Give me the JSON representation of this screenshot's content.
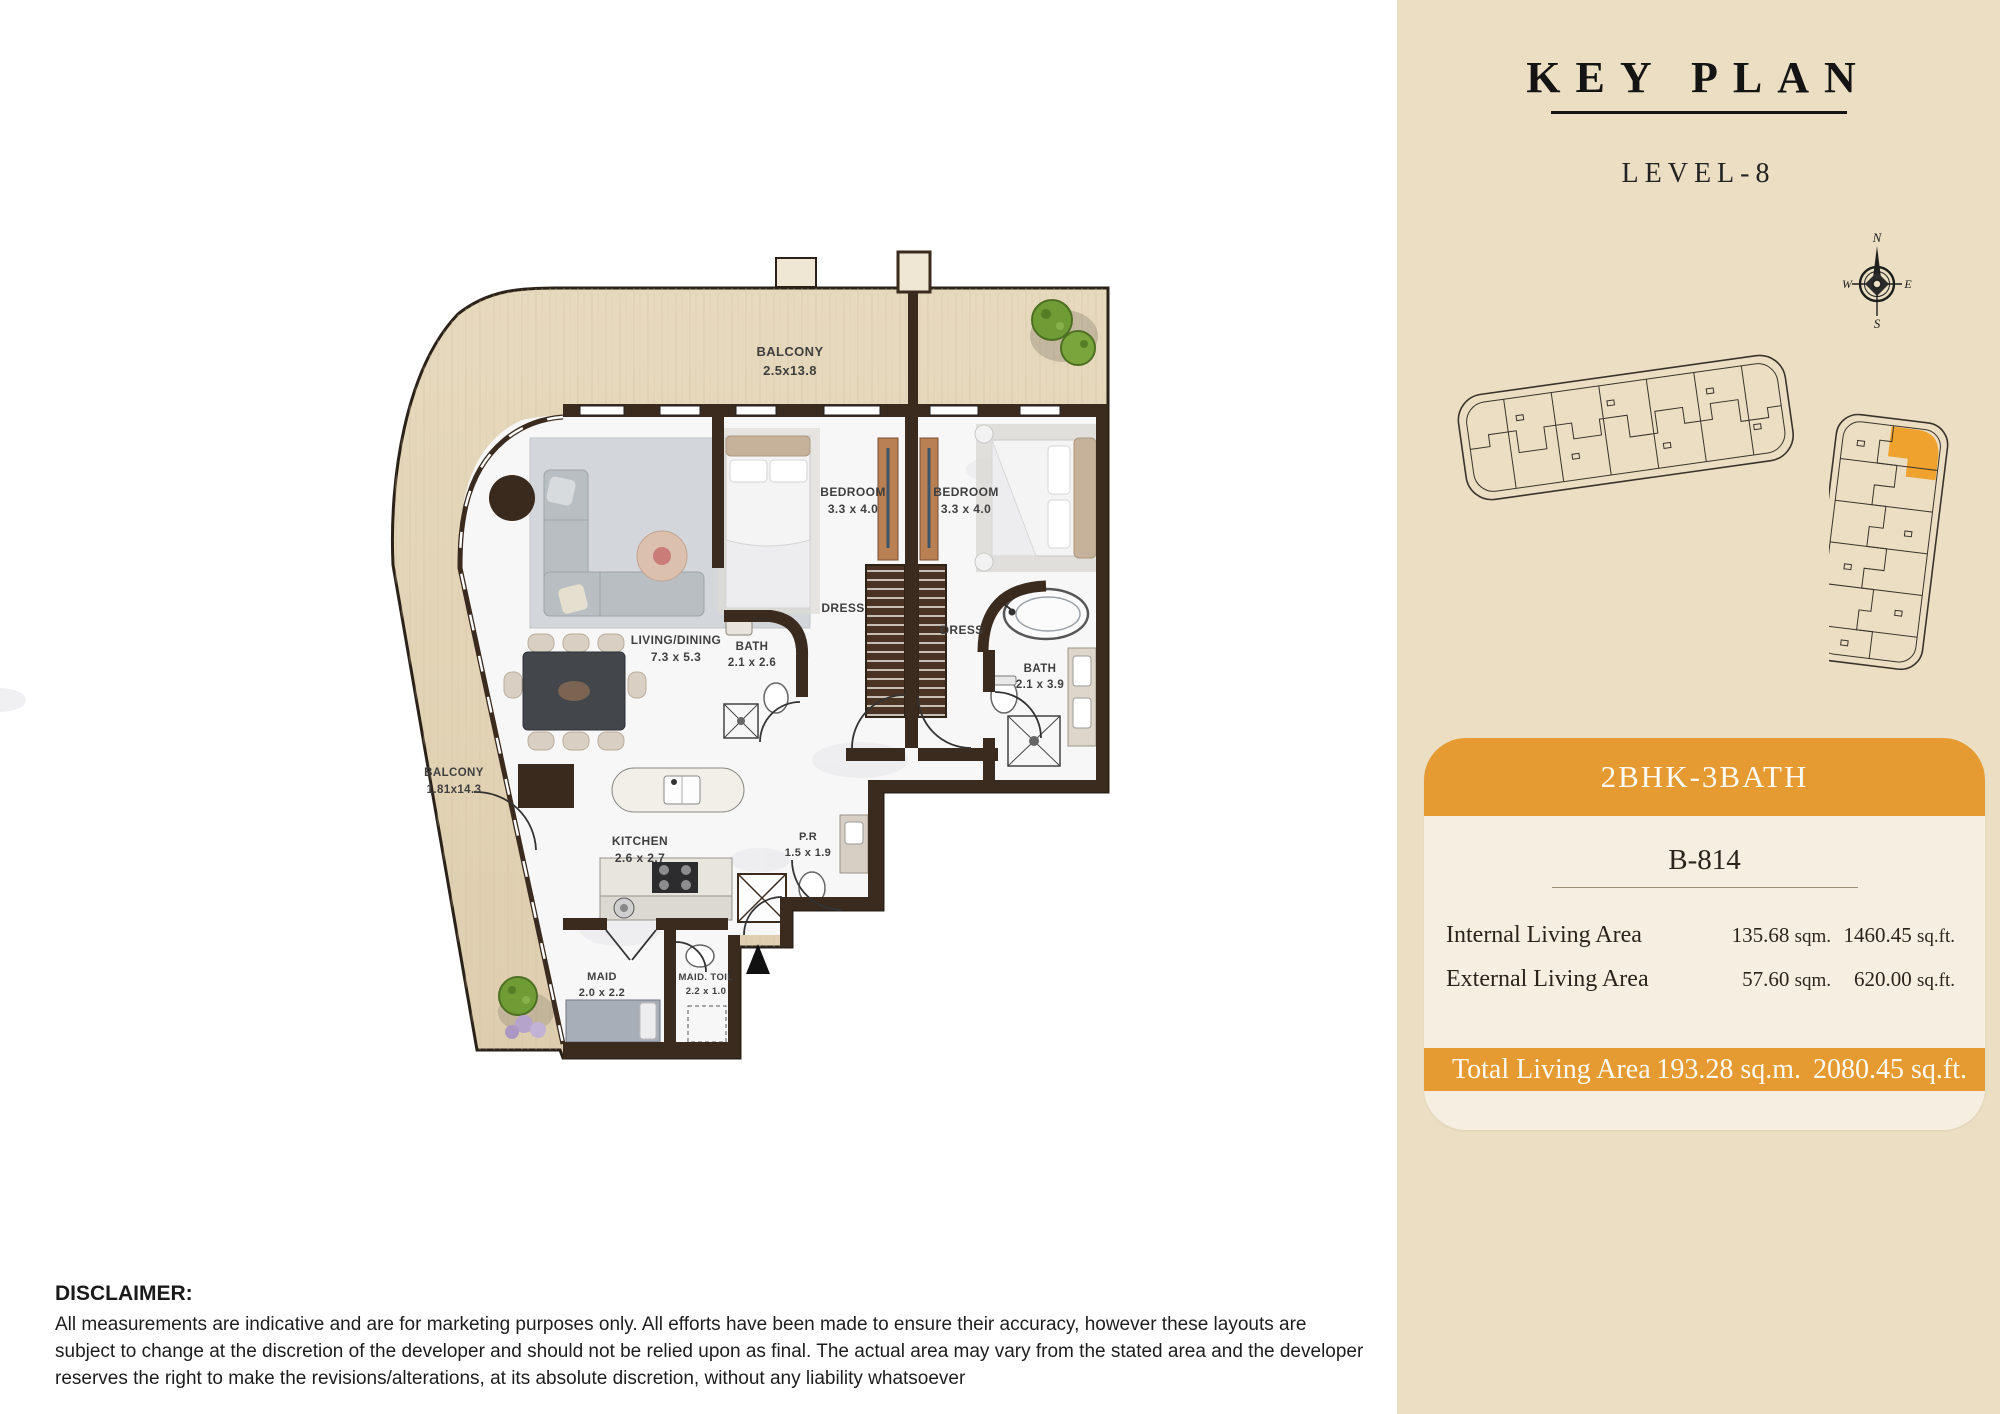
{
  "floor_plan": {
    "labels": {
      "balcony_top": {
        "name": "BALCONY",
        "dim": "2.5x13.8"
      },
      "balcony_left": {
        "name": "BALCONY",
        "dim": "1.81x14.3"
      },
      "living": {
        "name": "LIVING/DINING",
        "dim": "7.3 x 5.3"
      },
      "bedroom1": {
        "name": "BEDROOM",
        "dim": "3.3 x 4.0"
      },
      "bedroom2": {
        "name": "BEDROOM",
        "dim": "3.3 x 4.0"
      },
      "bath1": {
        "name": "BATH",
        "dim": "2.1 x 2.6"
      },
      "bath2": {
        "name": "BATH",
        "dim": "2.1 x 3.9"
      },
      "dress1": {
        "name": "DRESS"
      },
      "dress2": {
        "name": "DRESS"
      },
      "kitchen": {
        "name": "KITCHEN",
        "dim": "2.6 x 2.7"
      },
      "powder_room": {
        "name": "P.R",
        "dim": "1.5 x 1.9"
      },
      "maid": {
        "name": "MAID",
        "dim": "2.0 x 2.2"
      },
      "maid_toilet": {
        "name": "MAID. TOIL",
        "dim": "2.2 x 1.0"
      }
    }
  },
  "key_plan": {
    "title": "KEY PLAN",
    "level": "LEVEL-8",
    "compass": {
      "n": "N",
      "e": "E",
      "s": "S",
      "w": "W"
    }
  },
  "unit_card": {
    "type": "2BHK-3BATH",
    "unit": "B-814",
    "areas": [
      {
        "label": "Internal Living Area",
        "sqm": "135.68",
        "sqm_unit": "sqm.",
        "sqft": "1460.45",
        "sqft_unit": "sq.ft."
      },
      {
        "label": "External Living Area",
        "sqm": "57.60",
        "sqm_unit": "sqm.",
        "sqft": "620.00",
        "sqft_unit": "sq.ft."
      }
    ],
    "total": {
      "label": "Total Living Area",
      "sqm": "193.28 sq.m.",
      "sqft": "2080.45 sq.ft."
    }
  },
  "disclaimer": {
    "title": "DISCLAIMER:",
    "body": "All measurements are indicative and are for marketing purposes only. All efforts have been made to ensure their accuracy, however these layouts are subject to change at the discretion of the developer and should not be relied upon as final. The actual area may vary from the stated area and the developer reserves the right to make the revisions/alterations, at its absolute discretion, without any liability whatsoever"
  },
  "colors": {
    "accent_orange": "#E59B31",
    "panel_bg": "#EBDEC3",
    "card_bg": "#F6EEE0",
    "wall": "#3B2B1E",
    "wood": "#E3D4B8"
  }
}
